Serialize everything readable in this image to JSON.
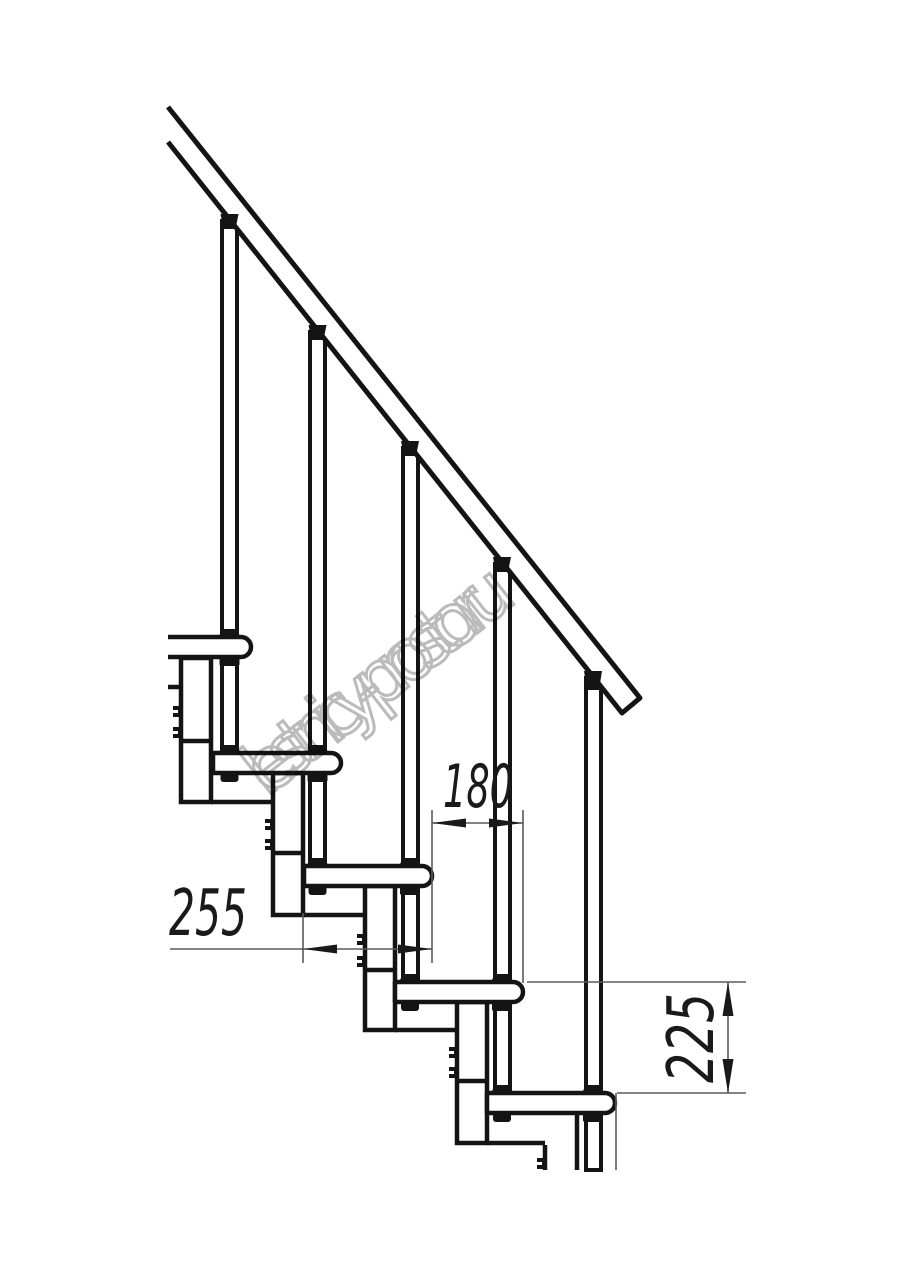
{
  "watermark": {
    "text": "lestnicy-prosto.ru",
    "color": "#b4b4b4"
  },
  "dimensions": {
    "run_label": "180",
    "depth_label": "255",
    "rise_label": "225"
  },
  "drawing": {
    "line_color": "#141414",
    "thin_line_color": "#5a5a5a",
    "arrow_color": "#1a1a1a",
    "background": "#ffffff"
  }
}
